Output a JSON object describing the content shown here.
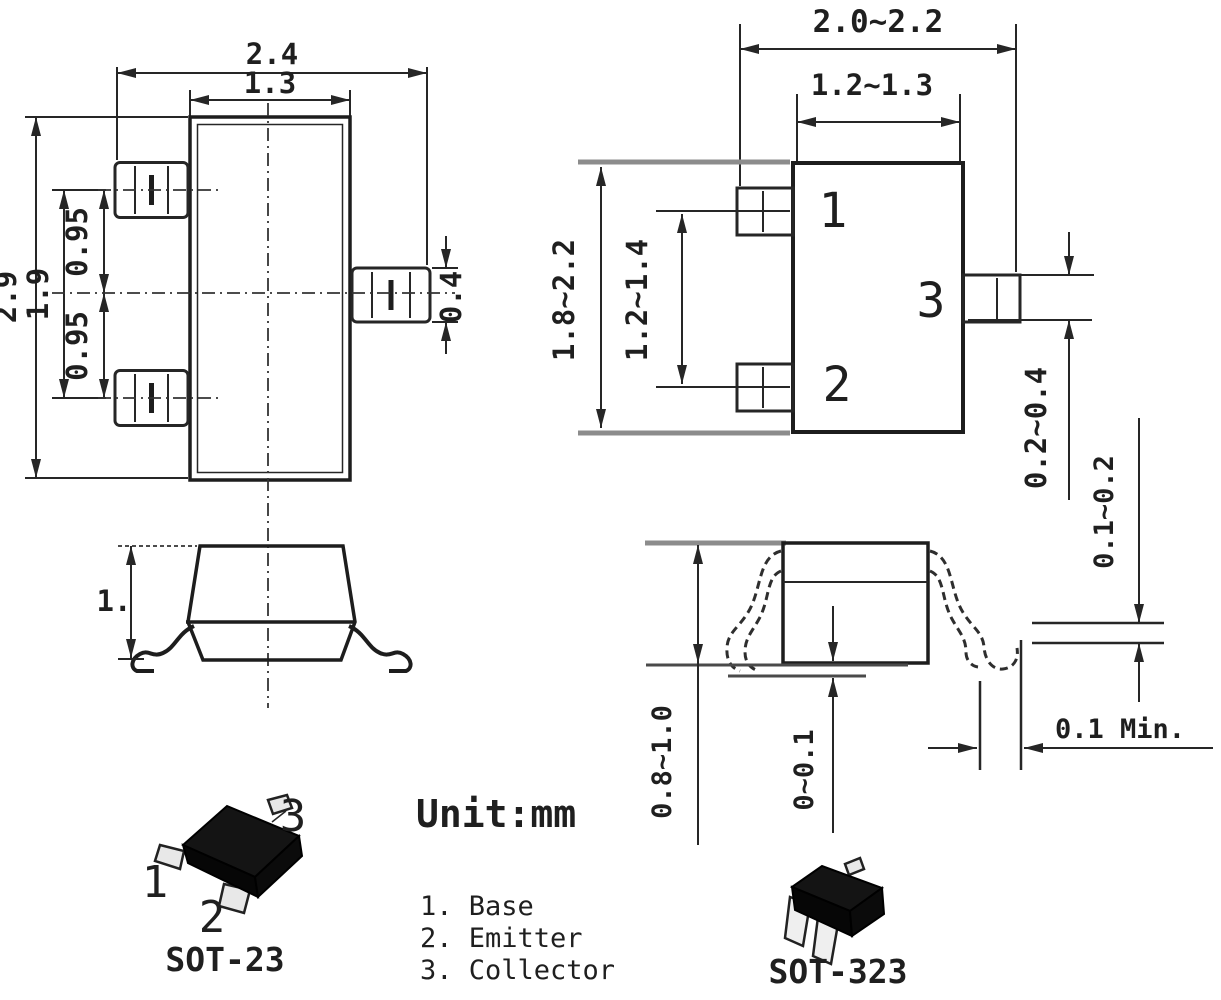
{
  "figure": {
    "unit_label": "Unit:mm",
    "legend": [
      "1. Base",
      "2. Emitter",
      "3. Collector"
    ],
    "sot23": {
      "caption": "SOT-23",
      "pins": {
        "p1": "1",
        "p2": "2",
        "p3": "3"
      },
      "dims": {
        "overall_width": "2.4",
        "body_width": "1.3",
        "overall_height": "2.9",
        "lead_span": "1.9",
        "pitch_upper": "0.95",
        "pitch_lower": "0.95",
        "lead_width": "0.4",
        "profile_height": "1."
      }
    },
    "sot323": {
      "caption": "SOT-323",
      "pins": {
        "p1": "1",
        "p2": "2",
        "p3": "3"
      },
      "dims": {
        "overall_width": "2.0~2.2",
        "body_width": "1.2~1.3",
        "overall_height": "1.8~2.2",
        "lead_span": "1.2~1.4",
        "lead_width": "0.2~0.4",
        "lead_thickness": "0.1~0.2",
        "body_height": "0.8~1.0",
        "standoff": "0~0.1",
        "clearance": "0.1 Min."
      }
    }
  }
}
